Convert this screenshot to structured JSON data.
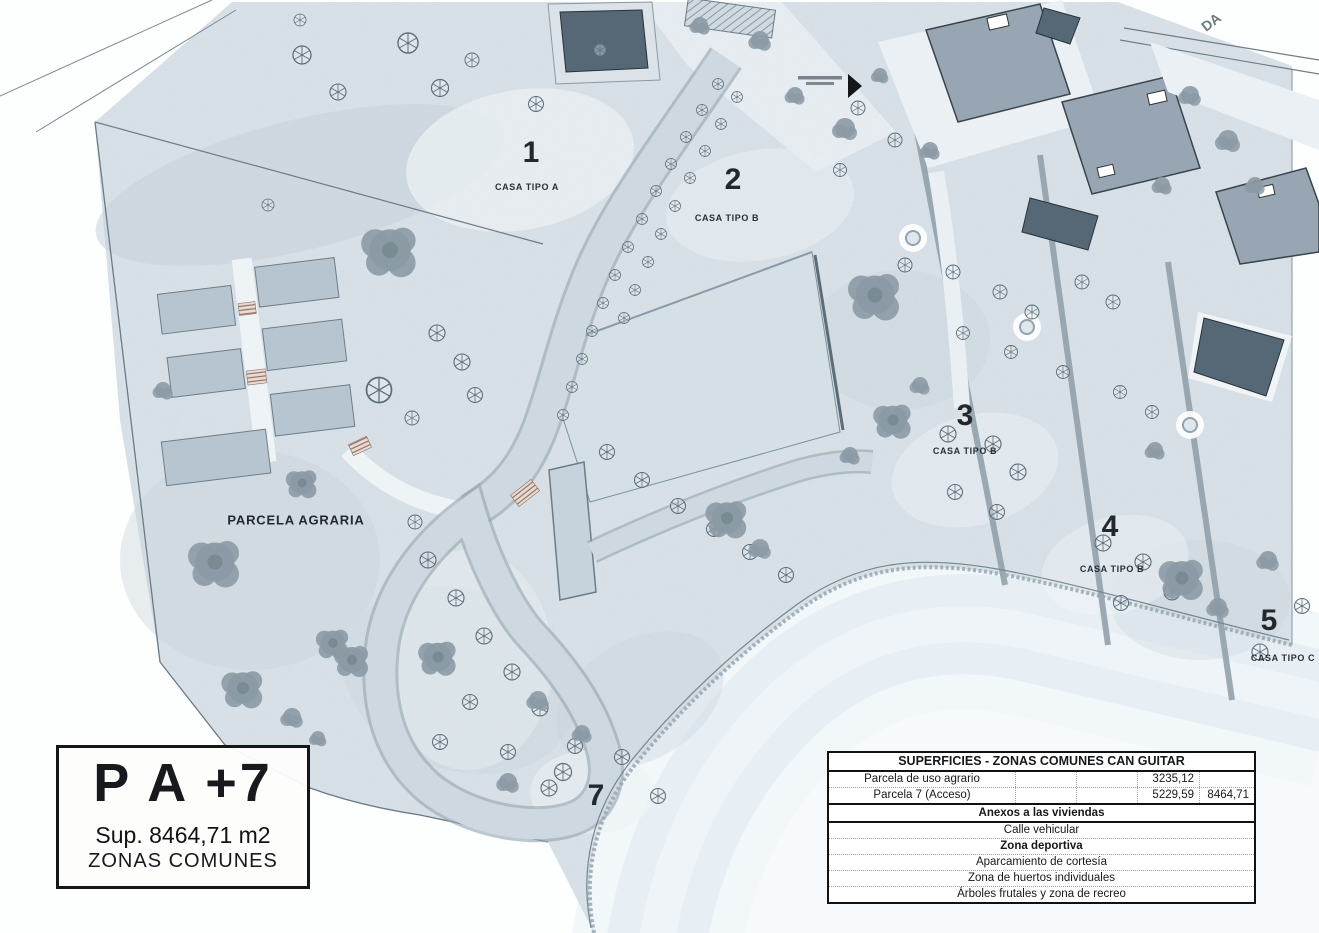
{
  "title_block": {
    "code": "P A +7",
    "area": "Sup. 8464,71 m2",
    "zone": "ZONAS COMUNES"
  },
  "plan_labels": {
    "parcels": {
      "p1": {
        "num": "1",
        "type": "CASA TIPO A"
      },
      "p2": {
        "num": "2",
        "type": "CASA TIPO B"
      },
      "p3": {
        "num": "3",
        "type": "CASA TIPO B"
      },
      "p4": {
        "num": "4",
        "type": "CASA TIPO B"
      },
      "p5": {
        "num": "5",
        "type": "CASA TIPO C"
      },
      "p7": {
        "num": "7"
      }
    },
    "agrarian_label": "PARCELA AGRARIA",
    "edge_text_fragment": "DA"
  },
  "surfaces_table": {
    "title": "SUPERFICIES - ZONAS COMUNES CAN GUITAR",
    "rows": [
      {
        "label": "Parcela de uso agrario",
        "c2": "",
        "c3": "",
        "value": "3235,12",
        "total": ""
      },
      {
        "label": "Parcela 7 (Acceso)",
        "c2": "",
        "c3": "",
        "value": "5229,59",
        "total": "8464,71"
      }
    ],
    "section_header": "Anexos a las viviendas",
    "annex_rows": [
      "Calle vehicular",
      "Zona deportiva",
      "Aparcamiento de cortesía",
      "Zona de huertos individuales",
      "Árboles frutales y zona de recreo"
    ]
  },
  "colors": {
    "land": "#dce4ea",
    "field": "#d5dfe6",
    "plot": "#b7c5d0",
    "roof": "#97a6b2",
    "pool": "#566876",
    "road": "#cdd8e0",
    "ribbon": "#e7eef4",
    "hedge": "#8d9ca7",
    "tree_dark": "#8b9aa5",
    "tree_outline": "#5d6d78",
    "ink": "#1c2125"
  }
}
